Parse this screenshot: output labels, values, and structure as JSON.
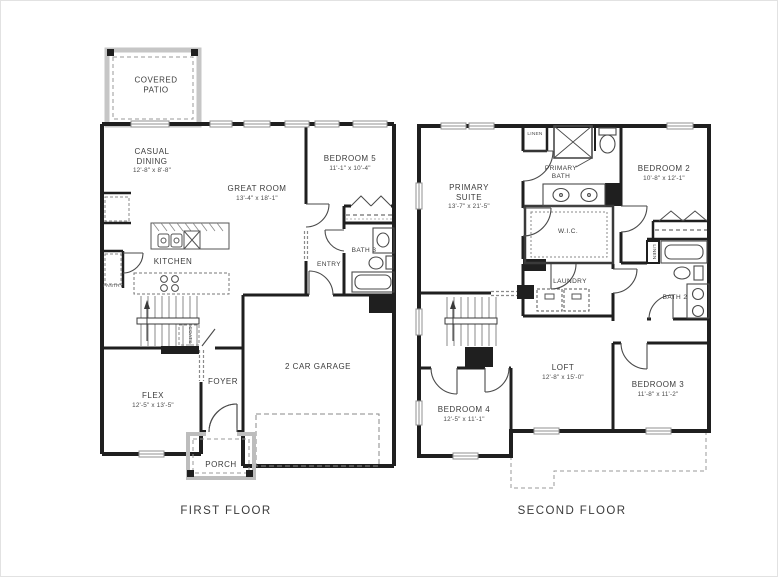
{
  "first_floor": {
    "caption": "FIRST FLOOR",
    "rooms": {
      "covered_patio": {
        "label": "COVERED PATIO"
      },
      "casual_dining": {
        "label": "CASUAL DINING",
        "dims": "12'-8\" x 8'-8\""
      },
      "great_room": {
        "label": "GREAT ROOM",
        "dims": "13'-4\" x 18'-1\""
      },
      "bedroom_5": {
        "label": "BEDROOM 5",
        "dims": "11'-1\" x 10'-4\""
      },
      "bath_3": {
        "label": "BATH 3"
      },
      "entry": {
        "label": "ENTRY"
      },
      "kitchen": {
        "label": "KITCHEN"
      },
      "pantry": {
        "label": "PANTRY"
      },
      "coats": {
        "label": "COATS"
      },
      "flex": {
        "label": "FLEX",
        "dims": "12'-5\" x 13'-5\""
      },
      "foyer": {
        "label": "FOYER"
      },
      "garage": {
        "label": "2 CAR GARAGE"
      },
      "porch": {
        "label": "PORCH"
      }
    }
  },
  "second_floor": {
    "caption": "SECOND FLOOR",
    "rooms": {
      "primary_suite": {
        "label": "PRIMARY SUITE",
        "dims": "13'-7\" x 21'-5\""
      },
      "linen_top": {
        "label": "LINEN"
      },
      "primary_bath": {
        "label": "PRIMARY BATH"
      },
      "bedroom_2": {
        "label": "BEDROOM 2",
        "dims": "10'-8\" x 12'-1\""
      },
      "wic": {
        "label": "W.I.C."
      },
      "laundry": {
        "label": "LAUNDRY"
      },
      "linen_hall": {
        "label": "LINEN"
      },
      "bath_2": {
        "label": "BATH 2"
      },
      "loft": {
        "label": "LOFT",
        "dims": "12'-8\" x 15'-0\""
      },
      "bedroom_3": {
        "label": "BEDROOM 3",
        "dims": "11'-8\" x 11'-2\""
      },
      "bedroom_4": {
        "label": "BEDROOM 4",
        "dims": "12'-5\" x 11'-1\""
      }
    }
  }
}
